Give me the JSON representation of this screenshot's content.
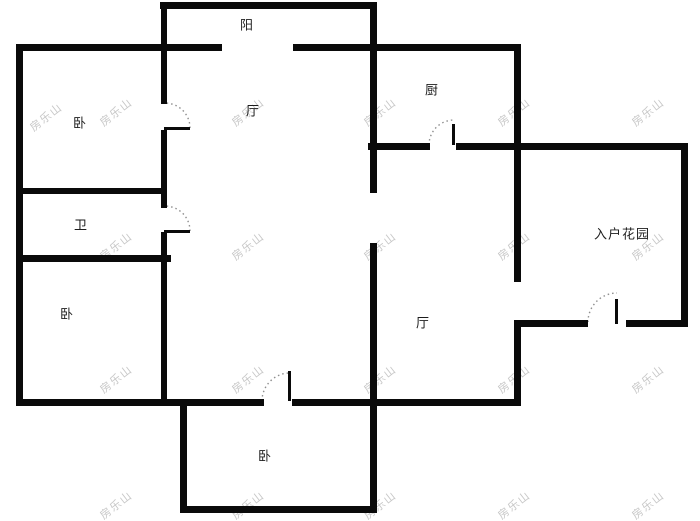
{
  "floorplan": {
    "title": "apartment-floor-plan",
    "colors": {
      "background": "#ffffff",
      "wall": "#0a0a0a",
      "label": "#1c1c1c",
      "watermark": "#c7c7c7",
      "door_arc": "#8f8f8f"
    },
    "rooms": [
      {
        "name": "balcony",
        "label": "阳",
        "x": 247,
        "y": 24
      },
      {
        "name": "living-room",
        "label": "厅",
        "x": 253,
        "y": 110
      },
      {
        "name": "kitchen",
        "label": "厨",
        "x": 432,
        "y": 89
      },
      {
        "name": "bedroom-1",
        "label": "卧",
        "x": 80,
        "y": 122
      },
      {
        "name": "bathroom",
        "label": "卫",
        "x": 81,
        "y": 224
      },
      {
        "name": "entry-garden",
        "label": "入户花园",
        "x": 622,
        "y": 233
      },
      {
        "name": "bedroom-2",
        "label": "卧",
        "x": 67,
        "y": 313
      },
      {
        "name": "dining-room",
        "label": "厅",
        "x": 423,
        "y": 322
      },
      {
        "name": "bedroom-3",
        "label": "卧",
        "x": 265,
        "y": 455
      }
    ],
    "walls": [
      {
        "x": 160,
        "y": 2,
        "w": 217,
        "h": 7
      },
      {
        "x": 16,
        "y": 44,
        "w": 206,
        "h": 7
      },
      {
        "x": 293,
        "y": 44,
        "w": 228,
        "h": 7
      },
      {
        "x": 16,
        "y": 44,
        "w": 7,
        "h": 362
      },
      {
        "x": 161,
        "y": 2,
        "w": 6,
        "h": 102
      },
      {
        "x": 161,
        "y": 130,
        "w": 6,
        "h": 78
      },
      {
        "x": 161,
        "y": 232,
        "w": 6,
        "h": 174
      },
      {
        "x": 20,
        "y": 188,
        "w": 146,
        "h": 6
      },
      {
        "x": 20,
        "y": 255,
        "w": 151,
        "h": 7
      },
      {
        "x": 370,
        "y": 2,
        "w": 7,
        "h": 191
      },
      {
        "x": 370,
        "y": 243,
        "w": 7,
        "h": 270
      },
      {
        "x": 368,
        "y": 143,
        "w": 62,
        "h": 7
      },
      {
        "x": 456,
        "y": 143,
        "w": 232,
        "h": 7
      },
      {
        "x": 514,
        "y": 44,
        "w": 7,
        "h": 238
      },
      {
        "x": 514,
        "y": 320,
        "w": 7,
        "h": 86
      },
      {
        "x": 681,
        "y": 143,
        "w": 7,
        "h": 184
      },
      {
        "x": 514,
        "y": 320,
        "w": 74,
        "h": 7
      },
      {
        "x": 626,
        "y": 320,
        "w": 62,
        "h": 7
      },
      {
        "x": 16,
        "y": 399,
        "w": 248,
        "h": 7
      },
      {
        "x": 292,
        "y": 399,
        "w": 229,
        "h": 7
      },
      {
        "x": 180,
        "y": 399,
        "w": 7,
        "h": 114
      },
      {
        "x": 180,
        "y": 506,
        "w": 197,
        "h": 7
      }
    ],
    "door_leaves": [
      {
        "x": 164,
        "y": 127,
        "w": 26,
        "h": 3
      },
      {
        "x": 164,
        "y": 230,
        "w": 26,
        "h": 3
      },
      {
        "x": 452,
        "y": 124,
        "w": 3,
        "h": 21
      },
      {
        "x": 288,
        "y": 371,
        "w": 3,
        "h": 30
      },
      {
        "x": 615,
        "y": 299,
        "w": 3,
        "h": 25
      }
    ],
    "door_arcs": [
      {
        "name": "bedroom-1-door-arc",
        "d": "M 190 128 A 25 25 0 0 0 165 103"
      },
      {
        "name": "bathroom-door-arc",
        "d": "M 190 231 A 25 25 0 0 0 165 206"
      },
      {
        "name": "kitchen-door-arc",
        "d": "M 429 145 A 25 25 0 0 1 454 120"
      },
      {
        "name": "bedroom-3-door-arc",
        "d": "M 262 401 A 28 28 0 0 1 290 373"
      },
      {
        "name": "entry-door-arc",
        "d": "M 588 322 A 29 29 0 0 1 617 293"
      }
    ],
    "watermark": {
      "text": "房乐山",
      "positions": [
        [
          46,
          117
        ],
        [
          116,
          112
        ],
        [
          248,
          112
        ],
        [
          380,
          112
        ],
        [
          514,
          112
        ],
        [
          648,
          112
        ],
        [
          116,
          246
        ],
        [
          248,
          246
        ],
        [
          380,
          246
        ],
        [
          514,
          246
        ],
        [
          648,
          246
        ],
        [
          116,
          379
        ],
        [
          248,
          379
        ],
        [
          380,
          379
        ],
        [
          514,
          379
        ],
        [
          648,
          379
        ],
        [
          116,
          505
        ],
        [
          248,
          505
        ],
        [
          380,
          505
        ],
        [
          514,
          505
        ],
        [
          648,
          505
        ]
      ]
    }
  }
}
